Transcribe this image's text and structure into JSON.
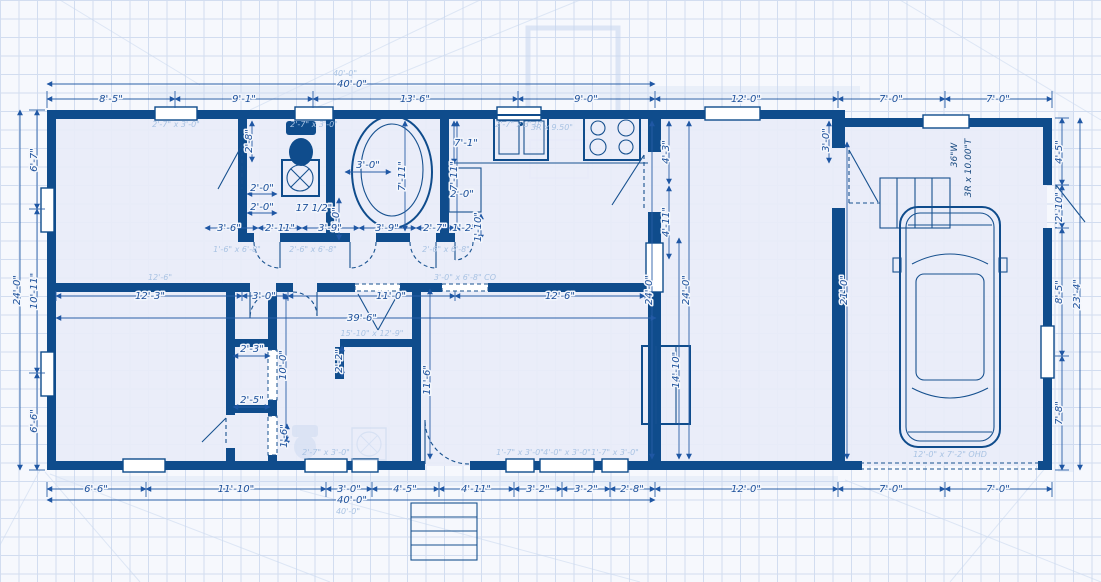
{
  "drawing": {
    "type": "house-floor-plan-blueprint",
    "colors": {
      "wall": "#0f4c8c",
      "dimension": "#1b4f9a",
      "room_fill": "#e8ecf8",
      "grid": "#d2ddf0",
      "ghost": "#a9c3e3"
    }
  },
  "plan": {
    "labels": [
      {
        "t": "40'-0\"",
        "x": 352,
        "y": 87
      },
      {
        "t": "8'-5\"",
        "x": 111,
        "y": 102
      },
      {
        "t": "9'-1\"",
        "x": 244,
        "y": 102
      },
      {
        "t": "13'-6\"",
        "x": 415,
        "y": 102
      },
      {
        "t": "9'-0\"",
        "x": 586,
        "y": 102
      },
      {
        "t": "12'-0\"",
        "x": 746,
        "y": 102
      },
      {
        "t": "7'-0\"",
        "x": 891,
        "y": 102
      },
      {
        "t": "7'-0\"",
        "x": 998,
        "y": 102
      },
      {
        "t": "6'-6\"",
        "x": 96,
        "y": 492
      },
      {
        "t": "11'-10\"",
        "x": 236,
        "y": 492
      },
      {
        "t": "3'-0\"",
        "x": 349,
        "y": 492
      },
      {
        "t": "4'-5\"",
        "x": 405,
        "y": 492
      },
      {
        "t": "4'-11\"",
        "x": 476,
        "y": 492
      },
      {
        "t": "3'-2\"",
        "x": 538,
        "y": 492
      },
      {
        "t": "3'-2\"",
        "x": 586,
        "y": 492
      },
      {
        "t": "2'-8\"",
        "x": 632,
        "y": 492
      },
      {
        "t": "12'-0\"",
        "x": 746,
        "y": 492
      },
      {
        "t": "7'-0\"",
        "x": 891,
        "y": 492
      },
      {
        "t": "7'-0\"",
        "x": 998,
        "y": 492
      },
      {
        "t": "40'-0\"",
        "x": 352,
        "y": 503
      },
      {
        "t": "6'-7\"",
        "x": 37,
        "y": 160,
        "r": -90
      },
      {
        "t": "10'-11\"",
        "x": 37,
        "y": 291,
        "r": -90
      },
      {
        "t": "6'-6\"",
        "x": 37,
        "y": 421,
        "r": -90
      },
      {
        "t": "24'-0\"",
        "x": 20,
        "y": 290,
        "r": -90
      },
      {
        "t": "4'-5\"",
        "x": 1062,
        "y": 152,
        "r": -90
      },
      {
        "t": "2'-10\"",
        "x": 1062,
        "y": 207,
        "r": -90
      },
      {
        "t": "8'-5\"",
        "x": 1062,
        "y": 292,
        "r": -90
      },
      {
        "t": "7'-8\"",
        "x": 1062,
        "y": 413,
        "r": -90
      },
      {
        "t": "23'-4\"",
        "x": 1080,
        "y": 294,
        "r": -90
      },
      {
        "t": "2'-8\"",
        "x": 252,
        "y": 141,
        "r": -90
      },
      {
        "t": "2'-0\"",
        "x": 262,
        "y": 191
      },
      {
        "t": "2'-0\"",
        "x": 262,
        "y": 210
      },
      {
        "t": "17 1/2\"",
        "x": 314,
        "y": 211
      },
      {
        "t": "3'-0\"",
        "x": 339,
        "y": 219,
        "r": -90
      },
      {
        "t": "3'-6\"",
        "x": 229,
        "y": 231
      },
      {
        "t": "2'-11\"",
        "x": 280,
        "y": 231
      },
      {
        "t": "3'-9\"",
        "x": 330,
        "y": 231
      },
      {
        "t": "3'-9\"",
        "x": 387,
        "y": 231
      },
      {
        "t": "2'-7\"",
        "x": 435,
        "y": 231
      },
      {
        "t": "1'-2\"",
        "x": 464,
        "y": 231
      },
      {
        "t": "2'-0\"",
        "x": 462,
        "y": 197
      },
      {
        "t": "1'-10\"",
        "x": 481,
        "y": 227,
        "r": -90
      },
      {
        "t": "3'-0\"",
        "x": 368,
        "y": 168
      },
      {
        "t": "7'-11\"",
        "x": 405,
        "y": 176,
        "r": -90
      },
      {
        "t": "7'-11\"",
        "x": 457,
        "y": 176,
        "r": -90
      },
      {
        "t": "7'-1\"",
        "x": 466,
        "y": 146
      },
      {
        "t": "4'-3\"",
        "x": 669,
        "y": 152,
        "r": -90
      },
      {
        "t": "4'-11\"",
        "x": 669,
        "y": 222,
        "r": -90
      },
      {
        "t": "24'-0\"",
        "x": 652,
        "y": 290,
        "r": -90
      },
      {
        "t": "24'-0\"",
        "x": 689,
        "y": 290,
        "r": -90
      },
      {
        "t": "12'-3\"",
        "x": 150,
        "y": 299
      },
      {
        "t": "3'-0\"",
        "x": 264,
        "y": 299
      },
      {
        "t": "11'-0\"",
        "x": 391,
        "y": 299
      },
      {
        "t": "12'-6\"",
        "x": 560,
        "y": 299
      },
      {
        "t": "39'-6\"",
        "x": 362,
        "y": 321
      },
      {
        "t": "14'-10\"",
        "x": 679,
        "y": 370,
        "r": -90
      },
      {
        "t": "21'-0\"",
        "x": 847,
        "y": 290,
        "r": -90
      },
      {
        "t": "3'-0\"",
        "x": 829,
        "y": 140,
        "r": -90
      },
      {
        "t": "10'-0\"",
        "x": 286,
        "y": 365,
        "r": -90
      },
      {
        "t": "2'-3\"",
        "x": 252,
        "y": 352
      },
      {
        "t": "2'-5\"",
        "x": 252,
        "y": 403
      },
      {
        "t": "1'-6\"",
        "x": 287,
        "y": 436,
        "r": -90
      },
      {
        "t": "2'-2\"",
        "x": 342,
        "y": 361,
        "r": -90
      },
      {
        "t": "11'-6\"",
        "x": 430,
        "y": 380,
        "r": -90
      },
      {
        "t": "36\"W",
        "x": 957,
        "y": 155,
        "r": -90,
        "c": "small"
      },
      {
        "t": "3R x 10.00\"T",
        "x": 971,
        "y": 168,
        "r": -90,
        "c": "small"
      },
      {
        "t": "40'-0\"",
        "x": 345,
        "y": 76,
        "c": "ghost"
      },
      {
        "t": "40'-0\"",
        "x": 348,
        "y": 514,
        "c": "ghost"
      },
      {
        "t": "12'-6\"",
        "x": 160,
        "y": 280,
        "c": "ghost"
      },
      {
        "t": "2'-7\" x 3'-0\"",
        "x": 176,
        "y": 127,
        "c": "ghost"
      },
      {
        "t": "2'-7\" x 3'-0\"",
        "x": 314,
        "y": 127,
        "c": "ghost"
      },
      {
        "t": "2'-7\" x 3'-0\"",
        "x": 519,
        "y": 127,
        "c": "ghost"
      },
      {
        "t": "1'-6\" x 6'-8\"",
        "x": 237,
        "y": 252,
        "c": "ghost"
      },
      {
        "t": "2'-6\" x 6'-8\"",
        "x": 313,
        "y": 252,
        "c": "ghost"
      },
      {
        "t": "2'-6\" x 6'-8\"",
        "x": 446,
        "y": 252,
        "c": "ghost"
      },
      {
        "t": "3'-0\" x 6'-8\" CO",
        "x": 465,
        "y": 280,
        "c": "ghost"
      },
      {
        "t": "15'-10\" x 12'-9\"",
        "x": 372,
        "y": 336,
        "c": "ghost"
      },
      {
        "t": "2'-7\" x 3'-0\"",
        "x": 326,
        "y": 455,
        "c": "ghost"
      },
      {
        "t": "1'-7\" x 3'-0\"",
        "x": 520,
        "y": 455,
        "c": "ghost"
      },
      {
        "t": "4'-0\" x 3'-0\"",
        "x": 567,
        "y": 455,
        "c": "ghost"
      },
      {
        "t": "1'-7\" x 3'-0\"",
        "x": 615,
        "y": 455,
        "c": "ghost"
      },
      {
        "t": "3R x 9.50\"",
        "x": 552,
        "y": 130,
        "c": "ghost"
      },
      {
        "t": "12'-0\" x 7'-2\" OHD",
        "x": 950,
        "y": 457,
        "c": "ghost"
      }
    ],
    "lines": [
      [
        47,
        84,
        655,
        84,
        1
      ],
      [
        47,
        99,
        175,
        99,
        1
      ],
      [
        175,
        99,
        313,
        99,
        1
      ],
      [
        313,
        99,
        518,
        99,
        1
      ],
      [
        518,
        99,
        655,
        99,
        1
      ],
      [
        655,
        99,
        838,
        99,
        1
      ],
      [
        838,
        99,
        945,
        99,
        1
      ],
      [
        945,
        99,
        1052,
        99,
        1
      ],
      [
        47,
        91,
        47,
        108,
        0
      ],
      [
        175,
        91,
        175,
        108,
        0
      ],
      [
        313,
        91,
        313,
        108,
        0
      ],
      [
        518,
        91,
        518,
        108,
        0
      ],
      [
        655,
        91,
        655,
        108,
        0
      ],
      [
        838,
        91,
        838,
        108,
        0
      ],
      [
        945,
        91,
        945,
        108,
        0
      ],
      [
        1052,
        91,
        1052,
        108,
        0
      ],
      [
        47,
        500,
        655,
        500,
        1
      ],
      [
        47,
        489,
        146,
        489,
        1
      ],
      [
        146,
        489,
        326,
        489,
        1
      ],
      [
        326,
        489,
        372,
        489,
        1
      ],
      [
        372,
        489,
        439,
        489,
        1
      ],
      [
        439,
        489,
        514,
        489,
        1
      ],
      [
        514,
        489,
        562,
        489,
        1
      ],
      [
        562,
        489,
        610,
        489,
        1
      ],
      [
        610,
        489,
        655,
        489,
        1
      ],
      [
        655,
        489,
        838,
        489,
        1
      ],
      [
        838,
        489,
        945,
        489,
        1
      ],
      [
        945,
        489,
        1052,
        489,
        1
      ],
      [
        47,
        482,
        47,
        497,
        0
      ],
      [
        146,
        482,
        146,
        497,
        0
      ],
      [
        326,
        482,
        326,
        497,
        0
      ],
      [
        372,
        482,
        372,
        497,
        0
      ],
      [
        439,
        482,
        439,
        497,
        0
      ],
      [
        514,
        482,
        514,
        497,
        0
      ],
      [
        562,
        482,
        562,
        497,
        0
      ],
      [
        610,
        482,
        610,
        497,
        0
      ],
      [
        655,
        482,
        655,
        497,
        0
      ],
      [
        838,
        482,
        838,
        497,
        0
      ],
      [
        945,
        482,
        945,
        497,
        0
      ],
      [
        1052,
        482,
        1052,
        497,
        0
      ],
      [
        20,
        110,
        20,
        470,
        1
      ],
      [
        37,
        110,
        37,
        209,
        1
      ],
      [
        37,
        209,
        37,
        373,
        1
      ],
      [
        37,
        373,
        37,
        470,
        1
      ],
      [
        29,
        110,
        45,
        110,
        0
      ],
      [
        29,
        209,
        45,
        209,
        0
      ],
      [
        29,
        373,
        45,
        373,
        0
      ],
      [
        29,
        470,
        45,
        470,
        0
      ],
      [
        1080,
        118,
        1080,
        470,
        1
      ],
      [
        1062,
        118,
        1062,
        185,
        1
      ],
      [
        1062,
        185,
        1062,
        228,
        1
      ],
      [
        1062,
        228,
        1062,
        356,
        1
      ],
      [
        1062,
        356,
        1062,
        470,
        1
      ],
      [
        1055,
        118,
        1069,
        118,
        0
      ],
      [
        1055,
        185,
        1069,
        185,
        0
      ],
      [
        1055,
        228,
        1069,
        228,
        0
      ],
      [
        1055,
        356,
        1069,
        356,
        0
      ],
      [
        1055,
        470,
        1069,
        470,
        0
      ],
      [
        205,
        228,
        258,
        228,
        1
      ],
      [
        258,
        228,
        302,
        228,
        1
      ],
      [
        302,
        228,
        359,
        228,
        1
      ],
      [
        359,
        228,
        416,
        228,
        1
      ],
      [
        416,
        228,
        455,
        228,
        1
      ],
      [
        455,
        228,
        473,
        228,
        1
      ],
      [
        56,
        296,
        242,
        296,
        1
      ],
      [
        242,
        296,
        288,
        296,
        1
      ],
      [
        288,
        296,
        455,
        296,
        1
      ],
      [
        455,
        296,
        645,
        296,
        1
      ],
      [
        56,
        291,
        56,
        301,
        0
      ],
      [
        242,
        291,
        242,
        301,
        0
      ],
      [
        288,
        291,
        288,
        301,
        0
      ],
      [
        455,
        291,
        455,
        301,
        0
      ],
      [
        645,
        291,
        645,
        301,
        0
      ],
      [
        56,
        318,
        656,
        318,
        1
      ],
      [
        405,
        121,
        405,
        231,
        1
      ],
      [
        457,
        121,
        457,
        231,
        1
      ],
      [
        454,
        121,
        454,
        164,
        1
      ],
      [
        252,
        121,
        252,
        162,
        1
      ],
      [
        339,
        198,
        339,
        240,
        1
      ],
      [
        481,
        214,
        481,
        240,
        1
      ],
      [
        345,
        172,
        391,
        172,
        1
      ],
      [
        669,
        121,
        669,
        184,
        1
      ],
      [
        669,
        186,
        669,
        259,
        1
      ],
      [
        652,
        121,
        652,
        459,
        1
      ],
      [
        689,
        121,
        689,
        459,
        1
      ],
      [
        679,
        238,
        679,
        459,
        1
      ],
      [
        847,
        142,
        847,
        459,
        1
      ],
      [
        829,
        121,
        829,
        163,
        1
      ],
      [
        430,
        289,
        430,
        459,
        1
      ],
      [
        286,
        294,
        286,
        442,
        1
      ],
      [
        233,
        356,
        270,
        356,
        1
      ],
      [
        233,
        407,
        270,
        407,
        1
      ],
      [
        287,
        424,
        287,
        446,
        1
      ],
      [
        342,
        346,
        342,
        377,
        1
      ],
      [
        247,
        194,
        277,
        194,
        1
      ],
      [
        247,
        213,
        277,
        213,
        1
      ]
    ]
  }
}
